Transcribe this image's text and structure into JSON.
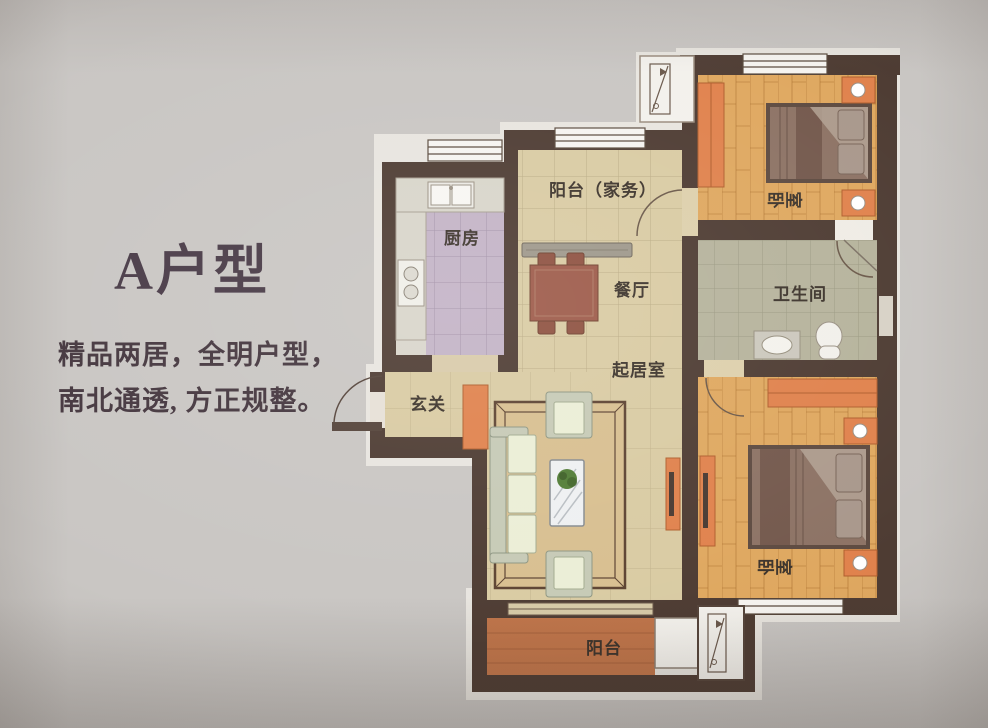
{
  "panel": {
    "title": "A户型",
    "description_lines": [
      "精品两居，全明户型，",
      "南北通透, 方正规整。"
    ]
  },
  "floorplan": {
    "rooms": [
      {
        "id": "service-balcony",
        "label": "阳台（家务）"
      },
      {
        "id": "kitchen",
        "label": "厨房"
      },
      {
        "id": "dining",
        "label": "餐厅"
      },
      {
        "id": "bedroom-north",
        "label": "卧室"
      },
      {
        "id": "bathroom",
        "label": "卫生间"
      },
      {
        "id": "living-room",
        "label": "起居室"
      },
      {
        "id": "foyer",
        "label": "玄关"
      },
      {
        "id": "bedroom-south",
        "label": "卧室"
      },
      {
        "id": "balcony",
        "label": "阳台"
      }
    ],
    "palette": {
      "wall": "#4e3c33",
      "floor_tan": "#d9cba3",
      "floor_wood": "#dfa860",
      "floor_kitchen": "#c3b3c6",
      "floor_bath": "#b6b39c",
      "floor_balcony": "#c0754a",
      "furniture_orange": "#e0824d",
      "dining_table": "#9d5a49",
      "text": "#44363e",
      "photo_background": "#c9c6c3"
    }
  }
}
